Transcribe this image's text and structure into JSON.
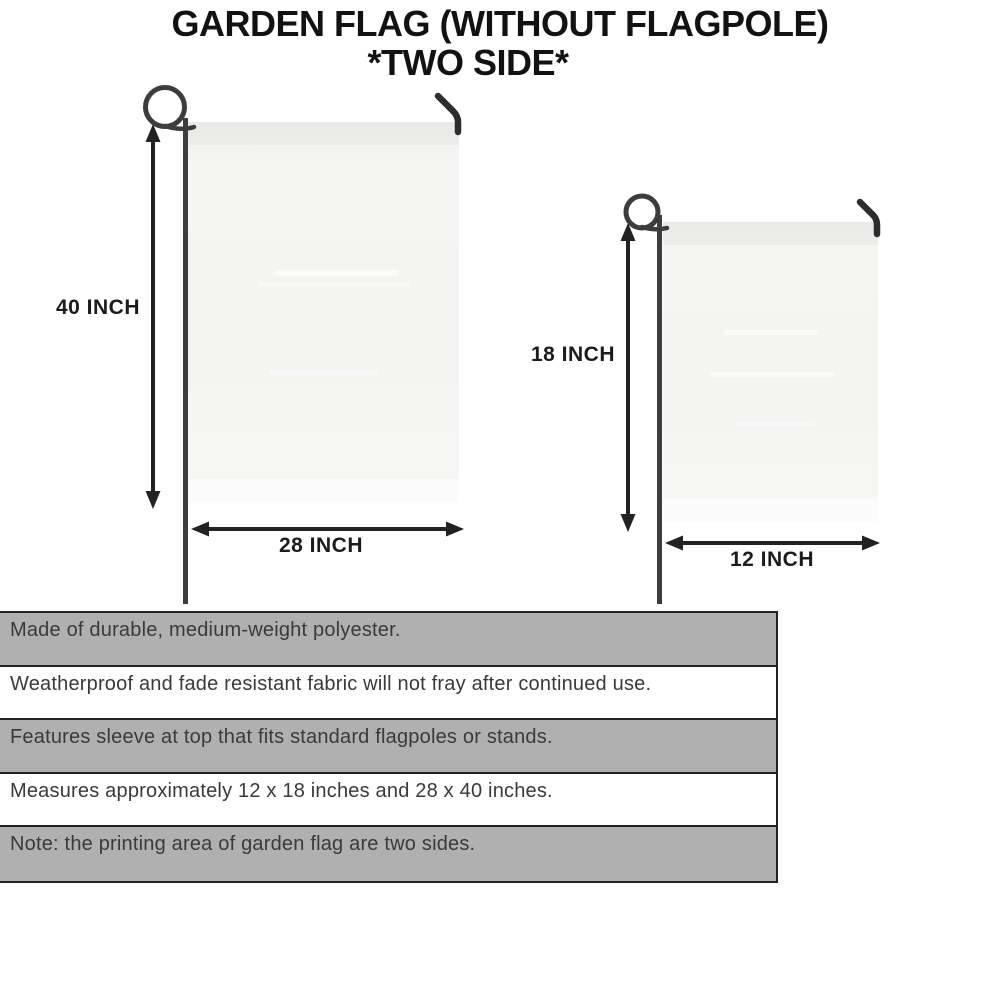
{
  "title": {
    "line1": "GARDEN FLAG (WITHOUT FLAGPOLE)",
    "line2": "*TWO SIDE*"
  },
  "flags": {
    "large": {
      "height_label": "40 INCH",
      "width_label": "28 INCH"
    },
    "small": {
      "height_label": "18 INCH",
      "width_label": "12 INCH"
    }
  },
  "features": [
    "Made of durable, medium-weight polyester.",
    "Weatherproof and fade resistant fabric will not fray after continued use.",
    "Features sleeve at top that fits standard flagpoles or stands.",
    "Measures approximately 12 x 18 inches and 28 x 40 inches.",
    "Note: the printing area of garden flag are two sides."
  ],
  "icons": {
    "flagpole": "shepherd-hook-flagpole-icon",
    "hook": "bent-hook-icon",
    "dimension_arrow": "double-headed-arrow-icon"
  },
  "colors": {
    "arrow_line": "#222222",
    "pole": "#3d3d3d",
    "hook": "#2d2d2d",
    "flag_fill": "#f4f4f2",
    "row_shaded": "#b0b0b0",
    "row_plain": "#ffffff",
    "row_border": "#222222",
    "row_text": "#3a3a3a",
    "title_text": "#121212"
  }
}
